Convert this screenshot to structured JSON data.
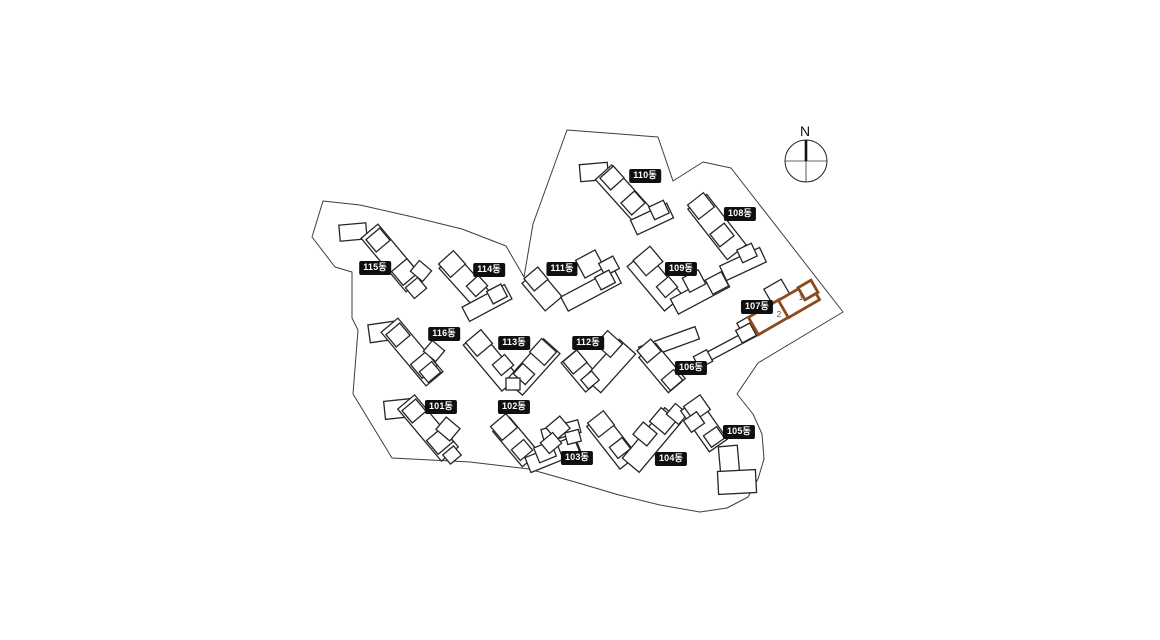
{
  "page": {
    "background": "#ffffff"
  },
  "compass": {
    "label": "N"
  },
  "site": {
    "stroke_color": "#3d3d3d",
    "boundary_points": "323,201 360,205 413,217 462,229 506,246 524,277 533,224 567,130 658,137 673,181 703,162 731,168 843,312 758,363 737,394 753,414 762,434 764,459 758,479 748,497 727,508 700,512 660,505 619,495 575,482 529,469 470,462 392,458 353,394 358,330 352,318 352,272 335,267 312,237"
  },
  "buildings": [
    {
      "id": "101",
      "label": "101동",
      "label_pos": [
        441,
        407
      ],
      "parts": [
        [
          398,
          409,
          27,
          18,
          -6
        ],
        [
          428,
          428,
          22,
          68,
          -40
        ],
        [
          414,
          411,
          18,
          16,
          -40
        ],
        [
          440,
          441,
          20,
          18,
          -40
        ],
        [
          448,
          429,
          18,
          16,
          40
        ],
        [
          452,
          455,
          14,
          12,
          -40
        ]
      ]
    },
    {
      "id": "102",
      "label": "102동",
      "label_pos": [
        514,
        407
      ],
      "parts": [
        [
          516,
          442,
          22,
          46,
          -40
        ],
        [
          553,
          455,
          54,
          16,
          -22
        ],
        [
          504,
          427,
          20,
          18,
          -40
        ],
        [
          522,
          450,
          16,
          14,
          -40
        ],
        [
          545,
          452,
          18,
          16,
          -22
        ],
        [
          568,
          447,
          18,
          16,
          -22
        ]
      ]
    },
    {
      "id": "103",
      "label": "103동",
      "label_pos": [
        577,
        458
      ],
      "parts": [
        [
          561,
          431,
          38,
          13,
          -15
        ],
        [
          558,
          428,
          18,
          16,
          -40
        ],
        [
          551,
          443,
          16,
          14,
          -40
        ],
        [
          573,
          437,
          14,
          12,
          -15
        ]
      ]
    },
    {
      "id": "104",
      "label": "104동",
      "label_pos": [
        671,
        459
      ],
      "parts": [
        [
          612,
          441,
          22,
          54,
          -38
        ],
        [
          652,
          440,
          22,
          66,
          40
        ],
        [
          601,
          424,
          20,
          18,
          -38
        ],
        [
          620,
          448,
          16,
          14,
          -38
        ],
        [
          645,
          434,
          18,
          16,
          40
        ],
        [
          663,
          421,
          20,
          18,
          40
        ],
        [
          677,
          414,
          16,
          14,
          40
        ]
      ]
    },
    {
      "id": "105",
      "label": "105동",
      "label_pos": [
        739,
        432
      ],
      "parts": [
        [
          704,
          425,
          22,
          50,
          -35
        ],
        [
          697,
          408,
          20,
          18,
          -35
        ],
        [
          694,
          422,
          16,
          14,
          -35
        ],
        [
          714,
          437,
          16,
          14,
          -35
        ],
        [
          729,
          460,
          19,
          28,
          -5
        ],
        [
          737,
          482,
          38,
          23,
          -3
        ]
      ]
    },
    {
      "id": "106",
      "label": "106동",
      "label_pos": [
        691,
        368
      ],
      "parts": [
        [
          669,
          343,
          60,
          13,
          -20
        ],
        [
          662,
          368,
          22,
          46,
          -40
        ],
        [
          649,
          351,
          18,
          16,
          -40
        ],
        [
          672,
          380,
          16,
          14,
          -40
        ]
      ]
    },
    {
      "id": "107",
      "label": "107동",
      "label_pos": [
        757,
        307
      ],
      "parts": [
        [
          777,
          292,
          20,
          18,
          -30
        ],
        [
          750,
          326,
          20,
          18,
          -30
        ],
        [
          730,
          345,
          64,
          9,
          -28
        ],
        [
          746,
          333,
          16,
          14,
          -28
        ],
        [
          703,
          359,
          15,
          13,
          -28
        ]
      ]
    },
    {
      "id": "108",
      "label": "108동",
      "label_pos": [
        740,
        214
      ],
      "parts": [
        [
          717,
          227,
          24,
          64,
          -38
        ],
        [
          701,
          206,
          20,
          18,
          -38
        ],
        [
          722,
          235,
          18,
          16,
          -38
        ],
        [
          743,
          264,
          44,
          16,
          -25
        ],
        [
          747,
          253,
          16,
          14,
          -25
        ]
      ]
    },
    {
      "id": "109",
      "label": "109동",
      "label_pos": [
        681,
        269
      ],
      "parts": [
        [
          655,
          281,
          24,
          58,
          -40
        ],
        [
          700,
          293,
          58,
          17,
          -28
        ],
        [
          648,
          261,
          22,
          20,
          -40
        ],
        [
          667,
          287,
          16,
          14,
          -40
        ],
        [
          694,
          281,
          18,
          16,
          -28
        ],
        [
          717,
          283,
          18,
          16,
          -28
        ]
      ]
    },
    {
      "id": "110",
      "label": "110동",
      "label_pos": [
        645,
        176
      ],
      "parts": [
        [
          594,
          172,
          28,
          17,
          -5
        ],
        [
          625,
          196,
          22,
          64,
          -42
        ],
        [
          612,
          178,
          18,
          16,
          -42
        ],
        [
          633,
          203,
          18,
          16,
          -42
        ],
        [
          652,
          219,
          40,
          16,
          -25
        ],
        [
          659,
          210,
          16,
          14,
          -25
        ]
      ]
    },
    {
      "id": "111",
      "label": "111동",
      "label_pos": [
        562,
        269
      ],
      "parts": [
        [
          542,
          290,
          22,
          36,
          -40
        ],
        [
          591,
          290,
          60,
          16,
          -28
        ],
        [
          590,
          264,
          22,
          20,
          -28
        ],
        [
          536,
          279,
          18,
          16,
          -40
        ],
        [
          609,
          266,
          16,
          14,
          -28
        ],
        [
          605,
          280,
          16,
          14,
          -28
        ]
      ]
    },
    {
      "id": "112",
      "label": "112동",
      "label_pos": [
        588,
        343
      ],
      "parts": [
        [
          581,
          371,
          20,
          38,
          -40
        ],
        [
          610,
          366,
          22,
          52,
          42
        ],
        [
          609,
          344,
          20,
          18,
          42
        ],
        [
          575,
          362,
          18,
          16,
          -40
        ],
        [
          590,
          380,
          14,
          12,
          -40
        ]
      ]
    },
    {
      "id": "113",
      "label": "113동",
      "label_pos": [
        514,
        343
      ],
      "parts": [
        [
          491,
          361,
          22,
          60,
          -40
        ],
        [
          533,
          367,
          22,
          56,
          42
        ],
        [
          479,
          343,
          20,
          18,
          -40
        ],
        [
          503,
          365,
          16,
          14,
          -40
        ],
        [
          543,
          352,
          20,
          18,
          42
        ],
        [
          524,
          374,
          16,
          14,
          42
        ],
        [
          513,
          384,
          14,
          12,
          0
        ]
      ]
    },
    {
      "id": "114",
      "label": "114동",
      "label_pos": [
        489,
        270
      ],
      "parts": [
        [
          468,
          284,
          22,
          62,
          -42
        ],
        [
          452,
          264,
          20,
          18,
          -42
        ],
        [
          477,
          286,
          16,
          14,
          -42
        ],
        [
          487,
          303,
          48,
          16,
          -28
        ],
        [
          497,
          294,
          16,
          14,
          -28
        ]
      ]
    },
    {
      "id": "115",
      "label": "115동",
      "label_pos": [
        375,
        268
      ],
      "parts": [
        [
          353,
          232,
          27,
          16,
          -5
        ],
        [
          392,
          258,
          22,
          70,
          -40
        ],
        [
          378,
          240,
          18,
          16,
          -40
        ],
        [
          405,
          272,
          20,
          18,
          -40
        ],
        [
          421,
          271,
          16,
          14,
          40
        ],
        [
          416,
          288,
          16,
          14,
          -40
        ]
      ]
    },
    {
      "id": "116",
      "label": "116동",
      "label_pos": [
        444,
        334
      ],
      "parts": [
        [
          382,
          332,
          26,
          18,
          -8
        ],
        [
          412,
          352,
          22,
          70,
          -40
        ],
        [
          398,
          335,
          18,
          16,
          -40
        ],
        [
          424,
          365,
          20,
          18,
          -40
        ],
        [
          434,
          351,
          16,
          14,
          40
        ],
        [
          430,
          372,
          16,
          14,
          -40
        ]
      ]
    }
  ],
  "highlight": {
    "building_id": "107",
    "color": "#8c4a1f",
    "parts": [
      [
        769,
        317,
        36,
        20,
        -30
      ],
      [
        799,
        300,
        36,
        20,
        -30
      ],
      [
        808,
        290,
        15,
        14,
        -30
      ]
    ],
    "units": [
      {
        "text": "1",
        "pos": [
          801,
          300
        ]
      },
      {
        "text": "2",
        "pos": [
          779,
          317
        ]
      }
    ]
  }
}
